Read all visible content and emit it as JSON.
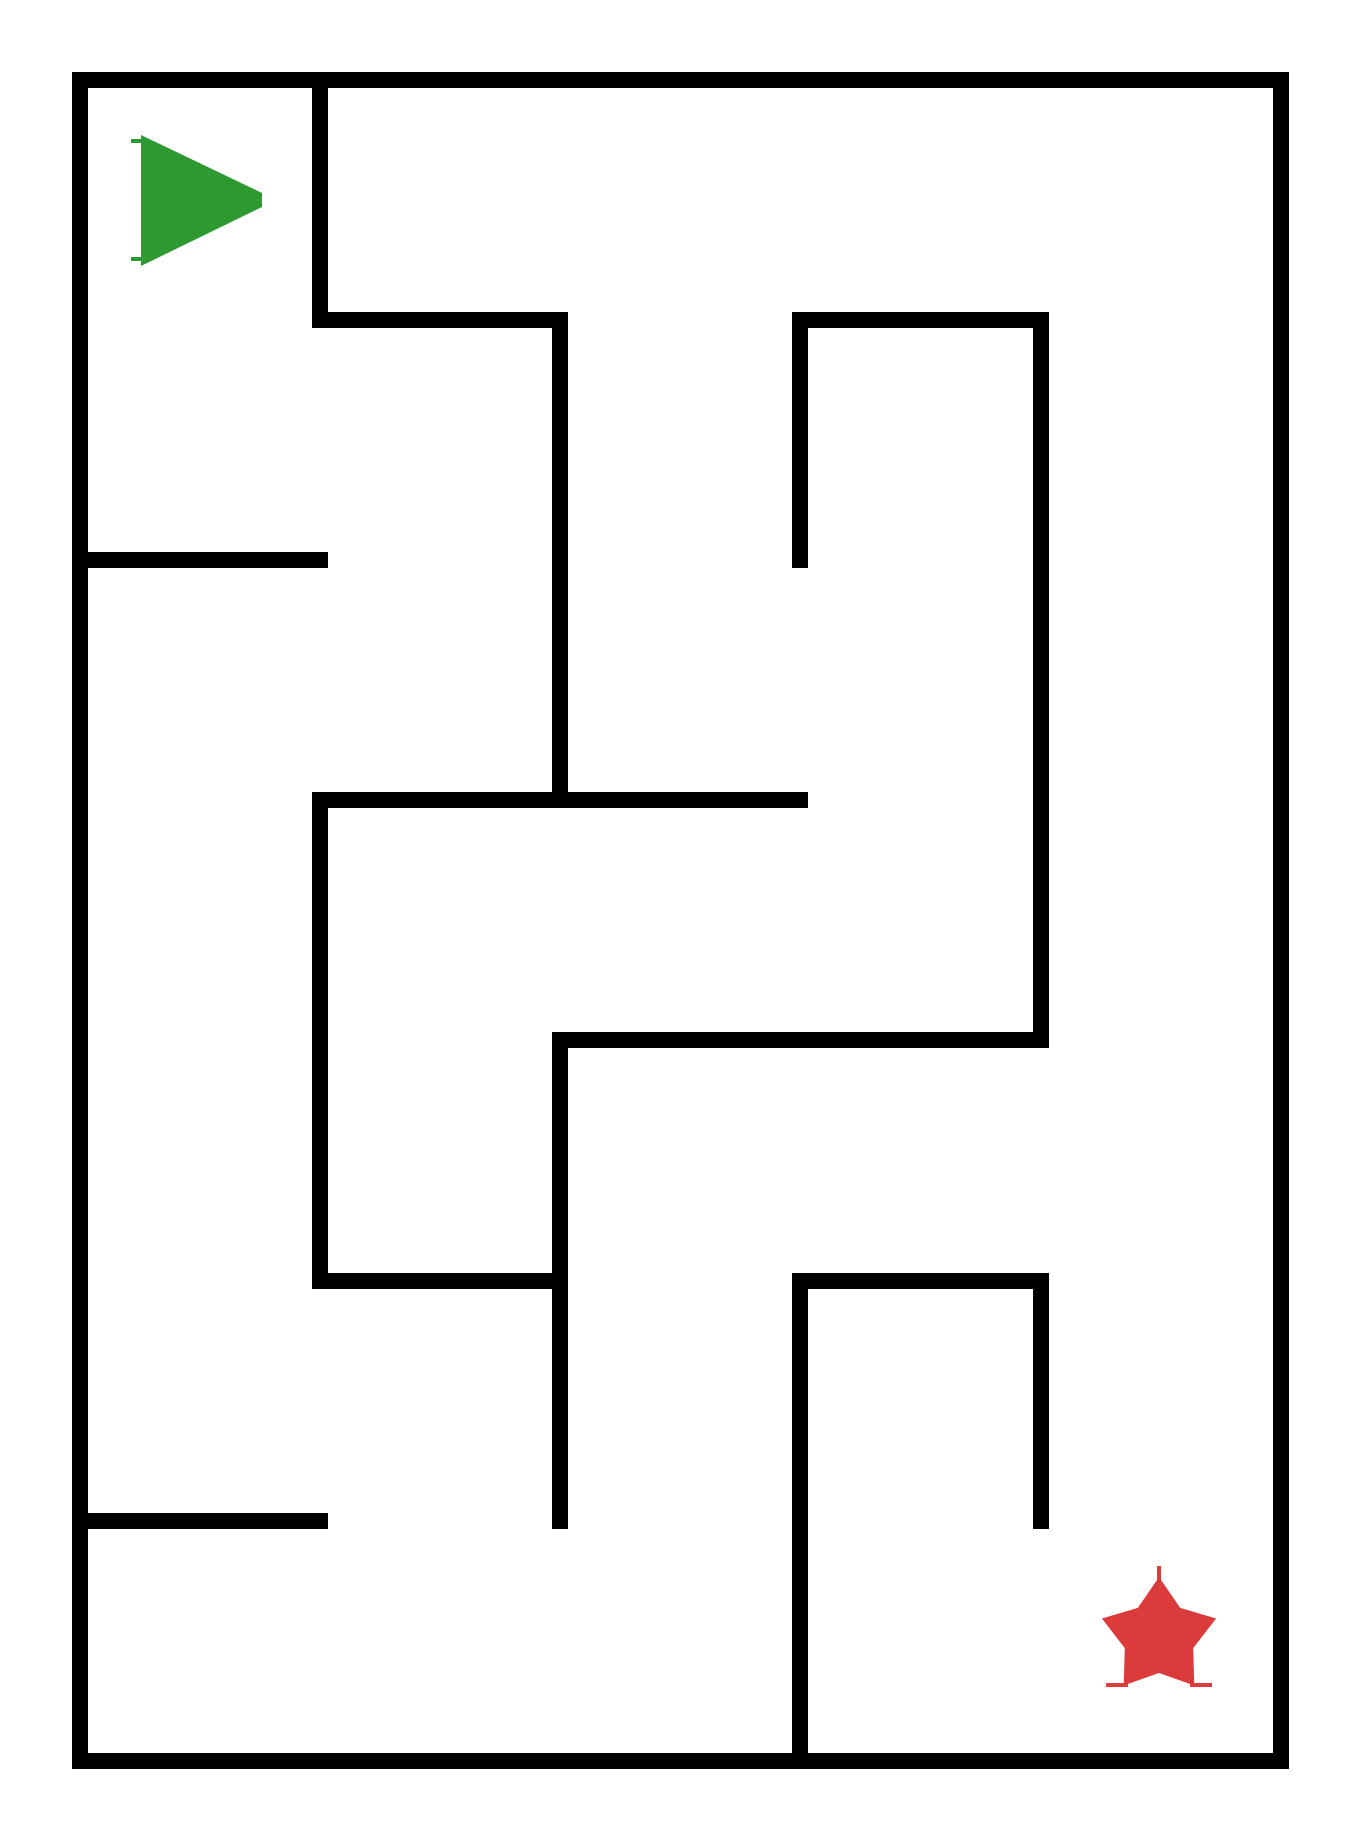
{
  "canvas": {
    "width": 1360,
    "height": 1840,
    "background": "#FFFFFF"
  },
  "maze": {
    "grid": {
      "cols": 5,
      "rows": 7,
      "cell_size": 240,
      "origin_x": 80,
      "origin_y": 80,
      "right_x": 1281,
      "bottom_y": 1761
    },
    "wall_thickness": 16,
    "wall_color": "#000000",
    "walls": [
      {
        "o": "h",
        "x": 80,
        "y": 80,
        "len": 1201,
        "name": "border-top"
      },
      {
        "o": "h",
        "x": 80,
        "y": 1761,
        "len": 1201,
        "name": "border-bottom"
      },
      {
        "o": "v",
        "x": 80,
        "y": 80,
        "len": 1681,
        "name": "border-left"
      },
      {
        "o": "v",
        "x": 1281,
        "y": 80,
        "len": 1681,
        "name": "border-right"
      },
      {
        "o": "v",
        "x": 320,
        "y": 80,
        "len": 240,
        "name": "wall-c1-r0"
      },
      {
        "o": "h",
        "x": 320,
        "y": 320,
        "len": 240,
        "name": "wall-r1-c1c2"
      },
      {
        "o": "v",
        "x": 560,
        "y": 320,
        "len": 480,
        "name": "wall-c2-r1r2"
      },
      {
        "o": "h",
        "x": 80,
        "y": 560,
        "len": 240,
        "name": "wall-r2-c0c1"
      },
      {
        "o": "h",
        "x": 800,
        "y": 320,
        "len": 241,
        "name": "wall-r1-c3c4"
      },
      {
        "o": "v",
        "x": 800,
        "y": 320,
        "len": 240,
        "name": "wall-c3-r1"
      },
      {
        "o": "v",
        "x": 1041,
        "y": 320,
        "len": 720,
        "name": "wall-c4-r1r3"
      },
      {
        "o": "h",
        "x": 320,
        "y": 800,
        "len": 480,
        "name": "wall-r3-c1c3"
      },
      {
        "o": "v",
        "x": 320,
        "y": 800,
        "len": 481,
        "name": "wall-c1-r3r4"
      },
      {
        "o": "h",
        "x": 560,
        "y": 1040,
        "len": 481,
        "name": "wall-r4-c2c4"
      },
      {
        "o": "v",
        "x": 560,
        "y": 1040,
        "len": 481,
        "name": "wall-c2-r4r5"
      },
      {
        "o": "h",
        "x": 320,
        "y": 1281,
        "len": 240,
        "name": "wall-r5-c1c2"
      },
      {
        "o": "h",
        "x": 80,
        "y": 1521,
        "len": 240,
        "name": "wall-r6-c0c1"
      },
      {
        "o": "h",
        "x": 800,
        "y": 1281,
        "len": 241,
        "name": "wall-r5-c3c4"
      },
      {
        "o": "v",
        "x": 800,
        "y": 1281,
        "len": 480,
        "name": "wall-c3-r5r6"
      },
      {
        "o": "v",
        "x": 1041,
        "y": 1281,
        "len": 240,
        "name": "wall-c4-r5"
      }
    ]
  },
  "start_marker": {
    "type": "triangle-right",
    "meaning": "maze start",
    "color": "#2D9930",
    "left_x": 141,
    "top_y": 135,
    "bottom_y": 266,
    "tip_x": 262,
    "tip_y": 200,
    "tip_half_height": 7,
    "serifs": [
      {
        "x": 131,
        "y": 139,
        "w": 11,
        "h": 4
      },
      {
        "x": 131,
        "y": 257,
        "w": 11,
        "h": 4
      }
    ]
  },
  "end_marker": {
    "type": "star-5-point",
    "meaning": "maze goal",
    "color": "#DB3B3B",
    "cx": 1159,
    "cy": 1637,
    "outer_radius": 60,
    "inner_radius": 36,
    "serifs": [
      {
        "x": 1106,
        "y": 1683,
        "w": 22,
        "h": 4
      },
      {
        "x": 1190,
        "y": 1683,
        "w": 22,
        "h": 4
      },
      {
        "x": 1157,
        "y": 1566,
        "w": 4,
        "h": 14
      }
    ]
  }
}
